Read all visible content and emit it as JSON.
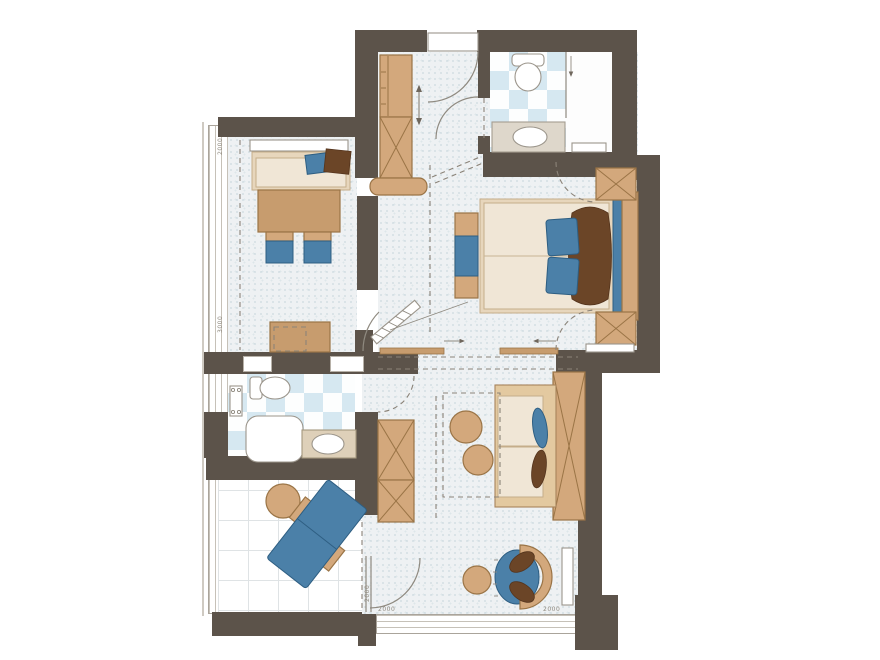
{
  "title": "hotel-suite-floor-plan",
  "colors": {
    "wall": "#5c534a",
    "floor_base": "#eef1f3",
    "speckle1": "#c9d6dc",
    "speckle2": "#dde6ea",
    "tile_blue": "#d6e8f1",
    "tile_white": "#fdfefe",
    "terrace_line": "#dfe3e5",
    "tan": "#d3a87c",
    "tan_dark": "#c79c6e",
    "tan_line": "#9a7446",
    "cream": "#f0e6d6",
    "frame": "#e7d6bc",
    "cream_line": "#c5ad8a",
    "blue": "#4b80a8",
    "blue_line": "#2e5e82",
    "brown": "#6b4527"
  },
  "dimension_labels": [
    {
      "text": "2000"
    },
    {
      "text": "3000"
    },
    {
      "text": "2000"
    },
    {
      "text": "2000"
    },
    {
      "text": "2000"
    }
  ],
  "elements": {
    "rooms": [
      "entry",
      "bathroom-top",
      "living-room",
      "bedroom",
      "bathroom-lower",
      "lower-room",
      "terrace"
    ],
    "fixture_icons": [
      "toilet-icon",
      "sink-icon",
      "shower-icon",
      "radiator-icon",
      "bed-icon",
      "sofa-icon",
      "wardrobe-x-icon",
      "lounge-chair-icon",
      "round-armchair-icon",
      "door-swing-arc",
      "sliding-door-arrow"
    ]
  }
}
